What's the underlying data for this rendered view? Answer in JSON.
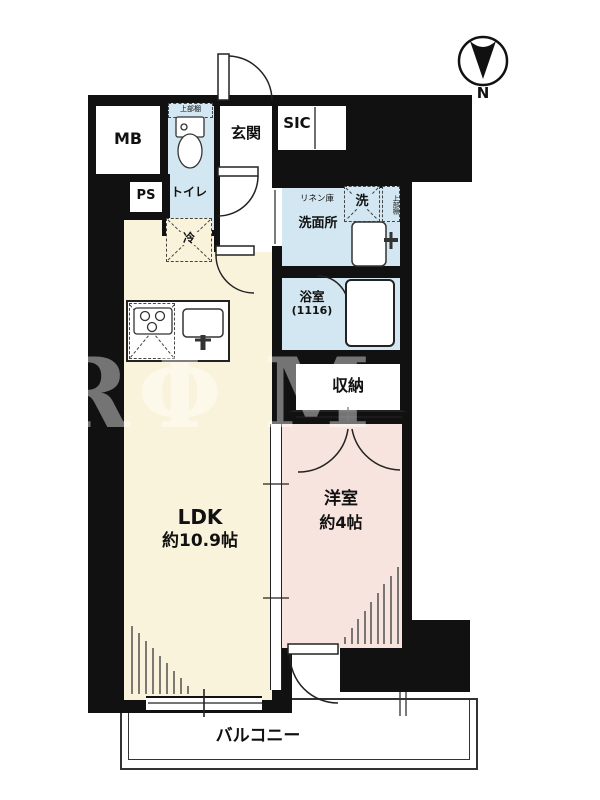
{
  "floorplan": {
    "compass_label": "N",
    "watermark": {
      "letters": [
        "R",
        "Φ",
        "M"
      ]
    },
    "labels": {
      "mb": "MB",
      "ps": "PS",
      "toilet": "トイレ",
      "toilet_shelf": "上部棚",
      "entrance": "玄関",
      "sic": "SIC",
      "linen": "リネン庫",
      "washer": "洗",
      "washer_shelf": "上部棚",
      "washroom": "洗面所",
      "bath_name": "浴室",
      "bath_size": "(1116)",
      "storage": "収納",
      "fridge": "冷",
      "ldk_name": "LDK",
      "ldk_size": "約10.9帖",
      "western_name": "洋室",
      "western_size": "約4帖",
      "balcony": "バルコニー"
    },
    "colors": {
      "wall": "#111111",
      "ldk": "#FAF3DB",
      "western": "#F8E4DE",
      "wet": "#D2E7F2",
      "line": "#222222"
    }
  }
}
